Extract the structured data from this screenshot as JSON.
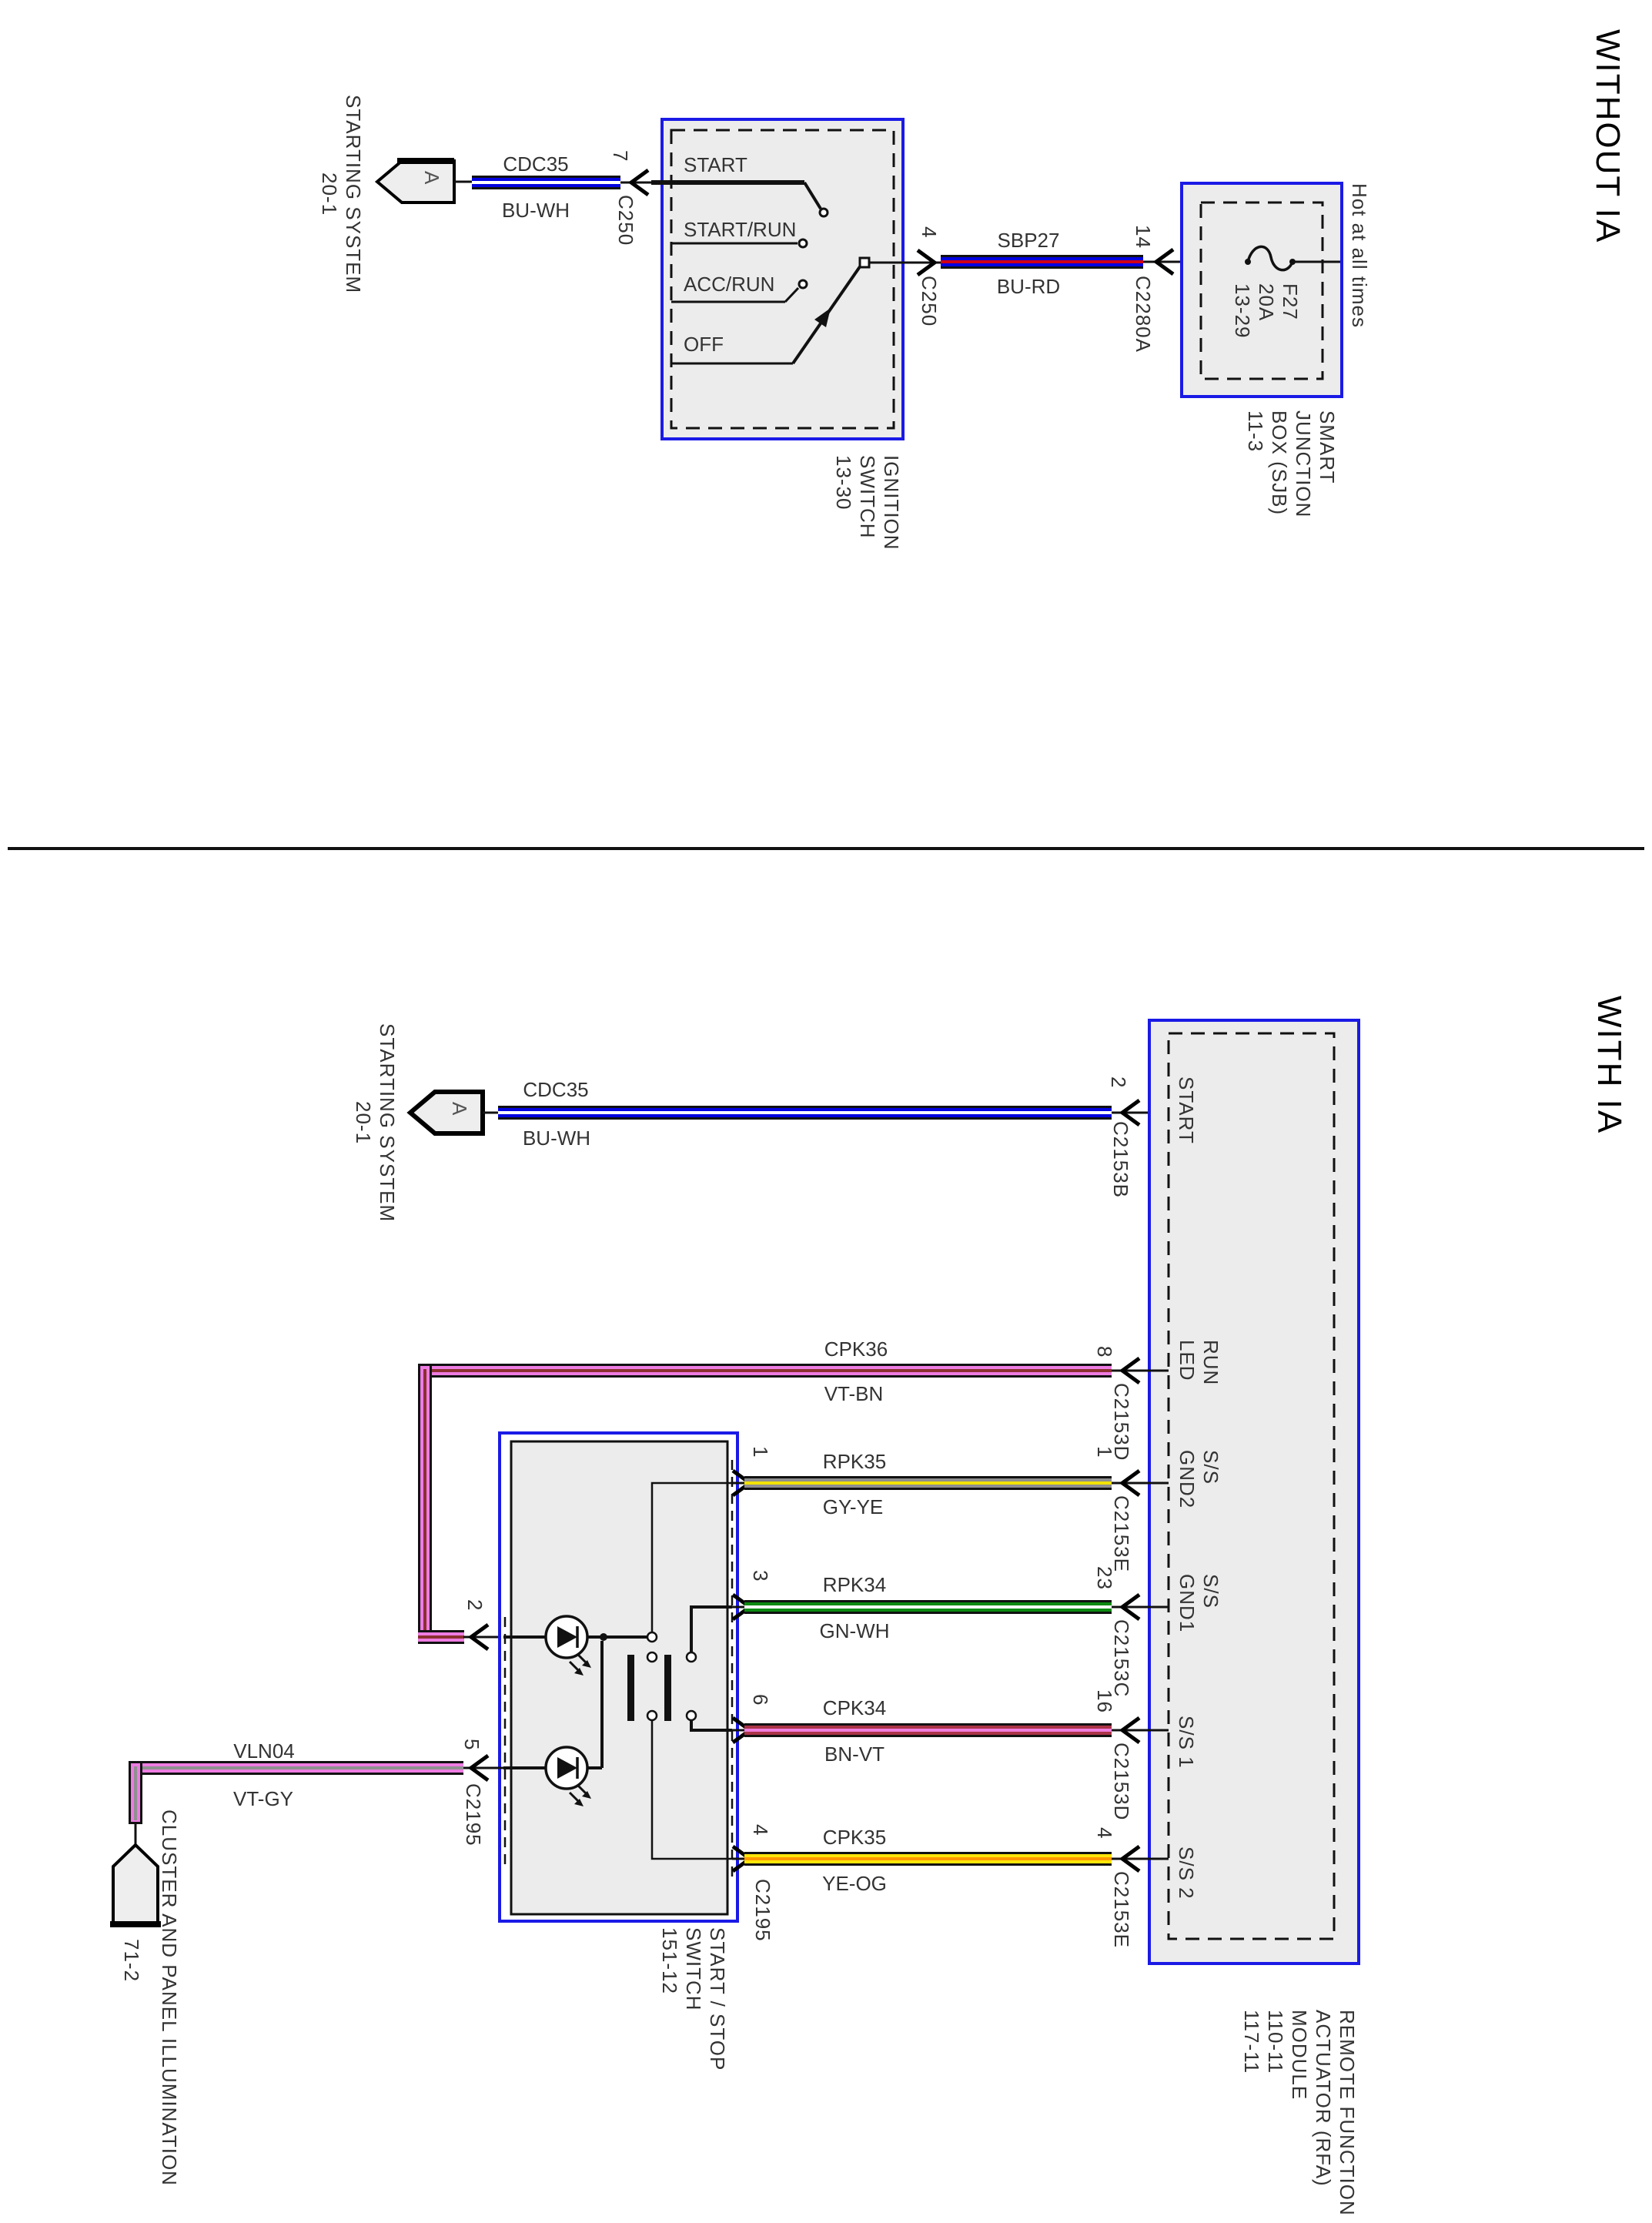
{
  "colors": {
    "background": "#ffffff",
    "component_stroke": "#1a1ae6",
    "component_fill": "#ececec",
    "wire_outline": "#111111",
    "label_text": "#333333"
  },
  "without_ia": {
    "title": "WITHOUT IA",
    "starting_system_ref": {
      "arrow_letter": "A",
      "label": "STARTING SYSTEM\n20-1"
    },
    "ignition_switch": {
      "positions": [
        "START",
        "START/RUN",
        "ACC/RUN",
        "OFF"
      ],
      "label": "IGNITION\nSWITCH\n13-30"
    },
    "sjb": {
      "hot_label": "Hot at all times",
      "fuse_label": "F27\n20A\n13-29",
      "label": "SMART\nJUNCTION\nBOX (SJB)\n11-3"
    },
    "wires": {
      "cdc35": {
        "code": "CDC35",
        "color": "BU-WH",
        "band": "#0202e0",
        "stripe": "#ffffff",
        "pin": "7",
        "connector": "C250"
      },
      "sbp27": {
        "code": "SBP27",
        "color": "BU-RD",
        "band": "#0202e0",
        "stripe": "#d10015",
        "pin_left": "4",
        "connector_left": "C250",
        "pin_right": "14",
        "connector_right": "C2280A"
      }
    }
  },
  "with_ia": {
    "title": "WITH IA",
    "starting_system_ref": {
      "arrow_letter": "A",
      "label": "STARTING SYSTEM\n20-1"
    },
    "rfa_module": {
      "pin_labels": {
        "start": "START",
        "run_led": "RUN\nLED",
        "ss_gnd2": "S/S\nGND2",
        "ss_gnd1": "S/S\nGND1",
        "ss1": "S/S 1",
        "ss2": "S/S 2"
      },
      "label": "REMOTE FUNCTION\nACTUATOR (RFA)\nMODULE\n110-11\n117-11"
    },
    "start_stop_switch": {
      "label": "START / STOP\nSWITCH\n151-12",
      "pins_right": [
        "1",
        "3",
        "6",
        "4"
      ],
      "pins_left": [
        "2",
        "5"
      ],
      "connector_right": "C2195",
      "connector_left": "C2195"
    },
    "cluster": {
      "label": "CLUSTER AND PANEL ILLUMINATION",
      "ref": "71-2"
    },
    "wires": {
      "cdc35": {
        "code": "CDC35",
        "color": "BU-WH",
        "band": "#0202e0",
        "stripe": "#ffffff",
        "pin": "2",
        "connector": "C2153B"
      },
      "cpk36": {
        "code": "CPK36",
        "color": "VT-BN",
        "band": "#ee7ce2",
        "stripe": "#8b3030",
        "pin_module": "8",
        "connector_module": "C2153D",
        "pin_switch": "2"
      },
      "rpk35": {
        "code": "RPK35",
        "color": "GY-YE",
        "band": "#8f8f8f",
        "stripe": "#f2e300",
        "pin_module": "1",
        "connector_module": "C2153E",
        "pin_switch": "1"
      },
      "rpk34": {
        "code": "RPK34",
        "color": "GN-WH",
        "band": "#0c8a12",
        "stripe": "#ffffff",
        "pin_module": "23",
        "connector_module": "C2153C",
        "pin_switch": "3"
      },
      "cpk34": {
        "code": "CPK34",
        "color": "BN-VT",
        "band": "#ab3448",
        "stripe": "#f07ddd",
        "pin_module": "16",
        "connector_module": "C2153D",
        "pin_switch": "6"
      },
      "cpk35": {
        "code": "CPK35",
        "color": "YE-OG",
        "band": "#ffe60a",
        "stripe": "#ff9800",
        "pin_module": "4",
        "connector_module": "C2153E",
        "pin_switch": "4"
      },
      "vln04": {
        "code": "VLN04",
        "color": "VT-GY",
        "band": "#ee7ce2",
        "stripe": "#909090",
        "pin_switch": "5",
        "connector_switch": "C2195"
      }
    }
  }
}
